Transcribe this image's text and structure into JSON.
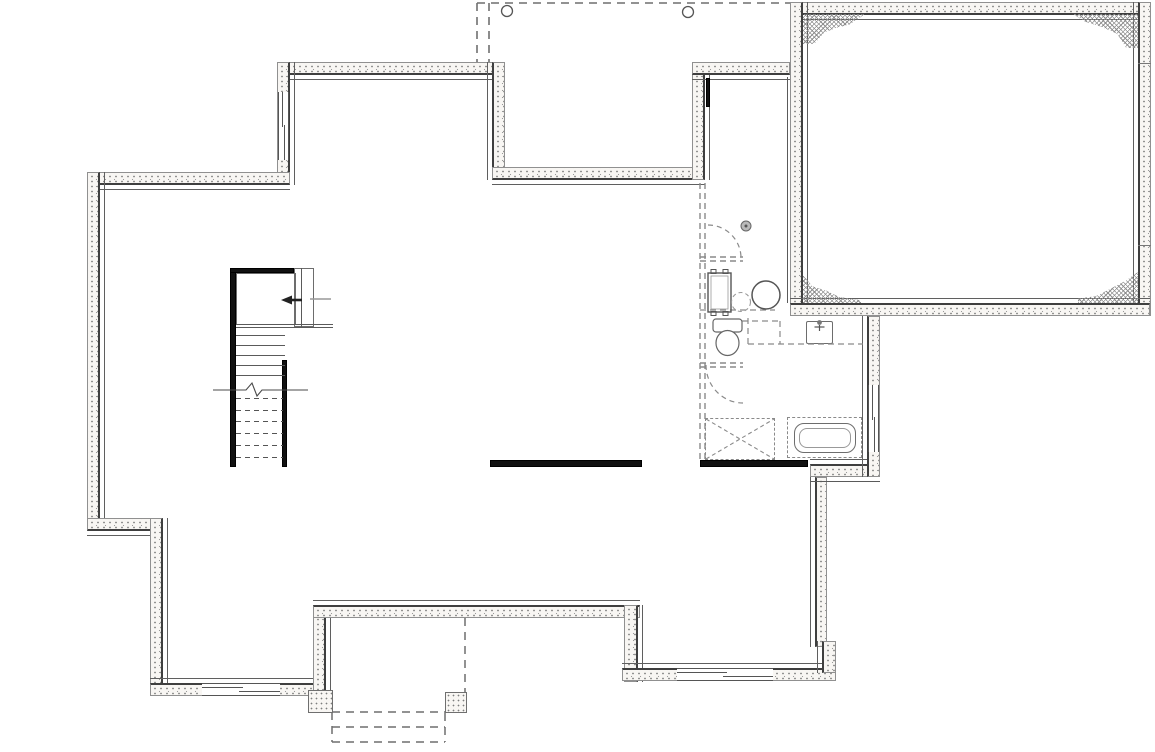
{
  "meta": {
    "drawing_type": "architectural floor plan",
    "view": "basement / foundation plan",
    "visible_text": "",
    "units_shown": "none"
  },
  "colors": {
    "background": "#ffffff",
    "wall_fill": "#f8f6f3",
    "wall_outer_line": "#909090",
    "wall_inner_line": "#3f3f3f",
    "thin_line": "#5a5a5a",
    "dashed_line": "#8a8a8a",
    "beam": "#111111",
    "hatch": "#8f8f8f"
  },
  "structure": {
    "garage": {
      "name": "garage foundation",
      "corner_pads": 4,
      "wall_joints": 2
    },
    "porch_top": {
      "name": "porch above (dashed)",
      "posts": 2
    },
    "deck_bottom": {
      "name": "deck / stoop above (dashed)",
      "piers": 2,
      "dashed_steps": 3
    },
    "windows": 4,
    "beams": 2
  },
  "stairs": {
    "name": "staircase",
    "solid_treads": 5,
    "dashed_treads": 6,
    "direction_arrow": "left",
    "break_line": true
  },
  "fixtures": [
    "furnace",
    "water-heater",
    "floor-drain",
    "softener-dashed-circle",
    "toilet",
    "laundry-tub",
    "bathtub",
    "shower-rough-in",
    "vanity-rough-in-dashed"
  ]
}
